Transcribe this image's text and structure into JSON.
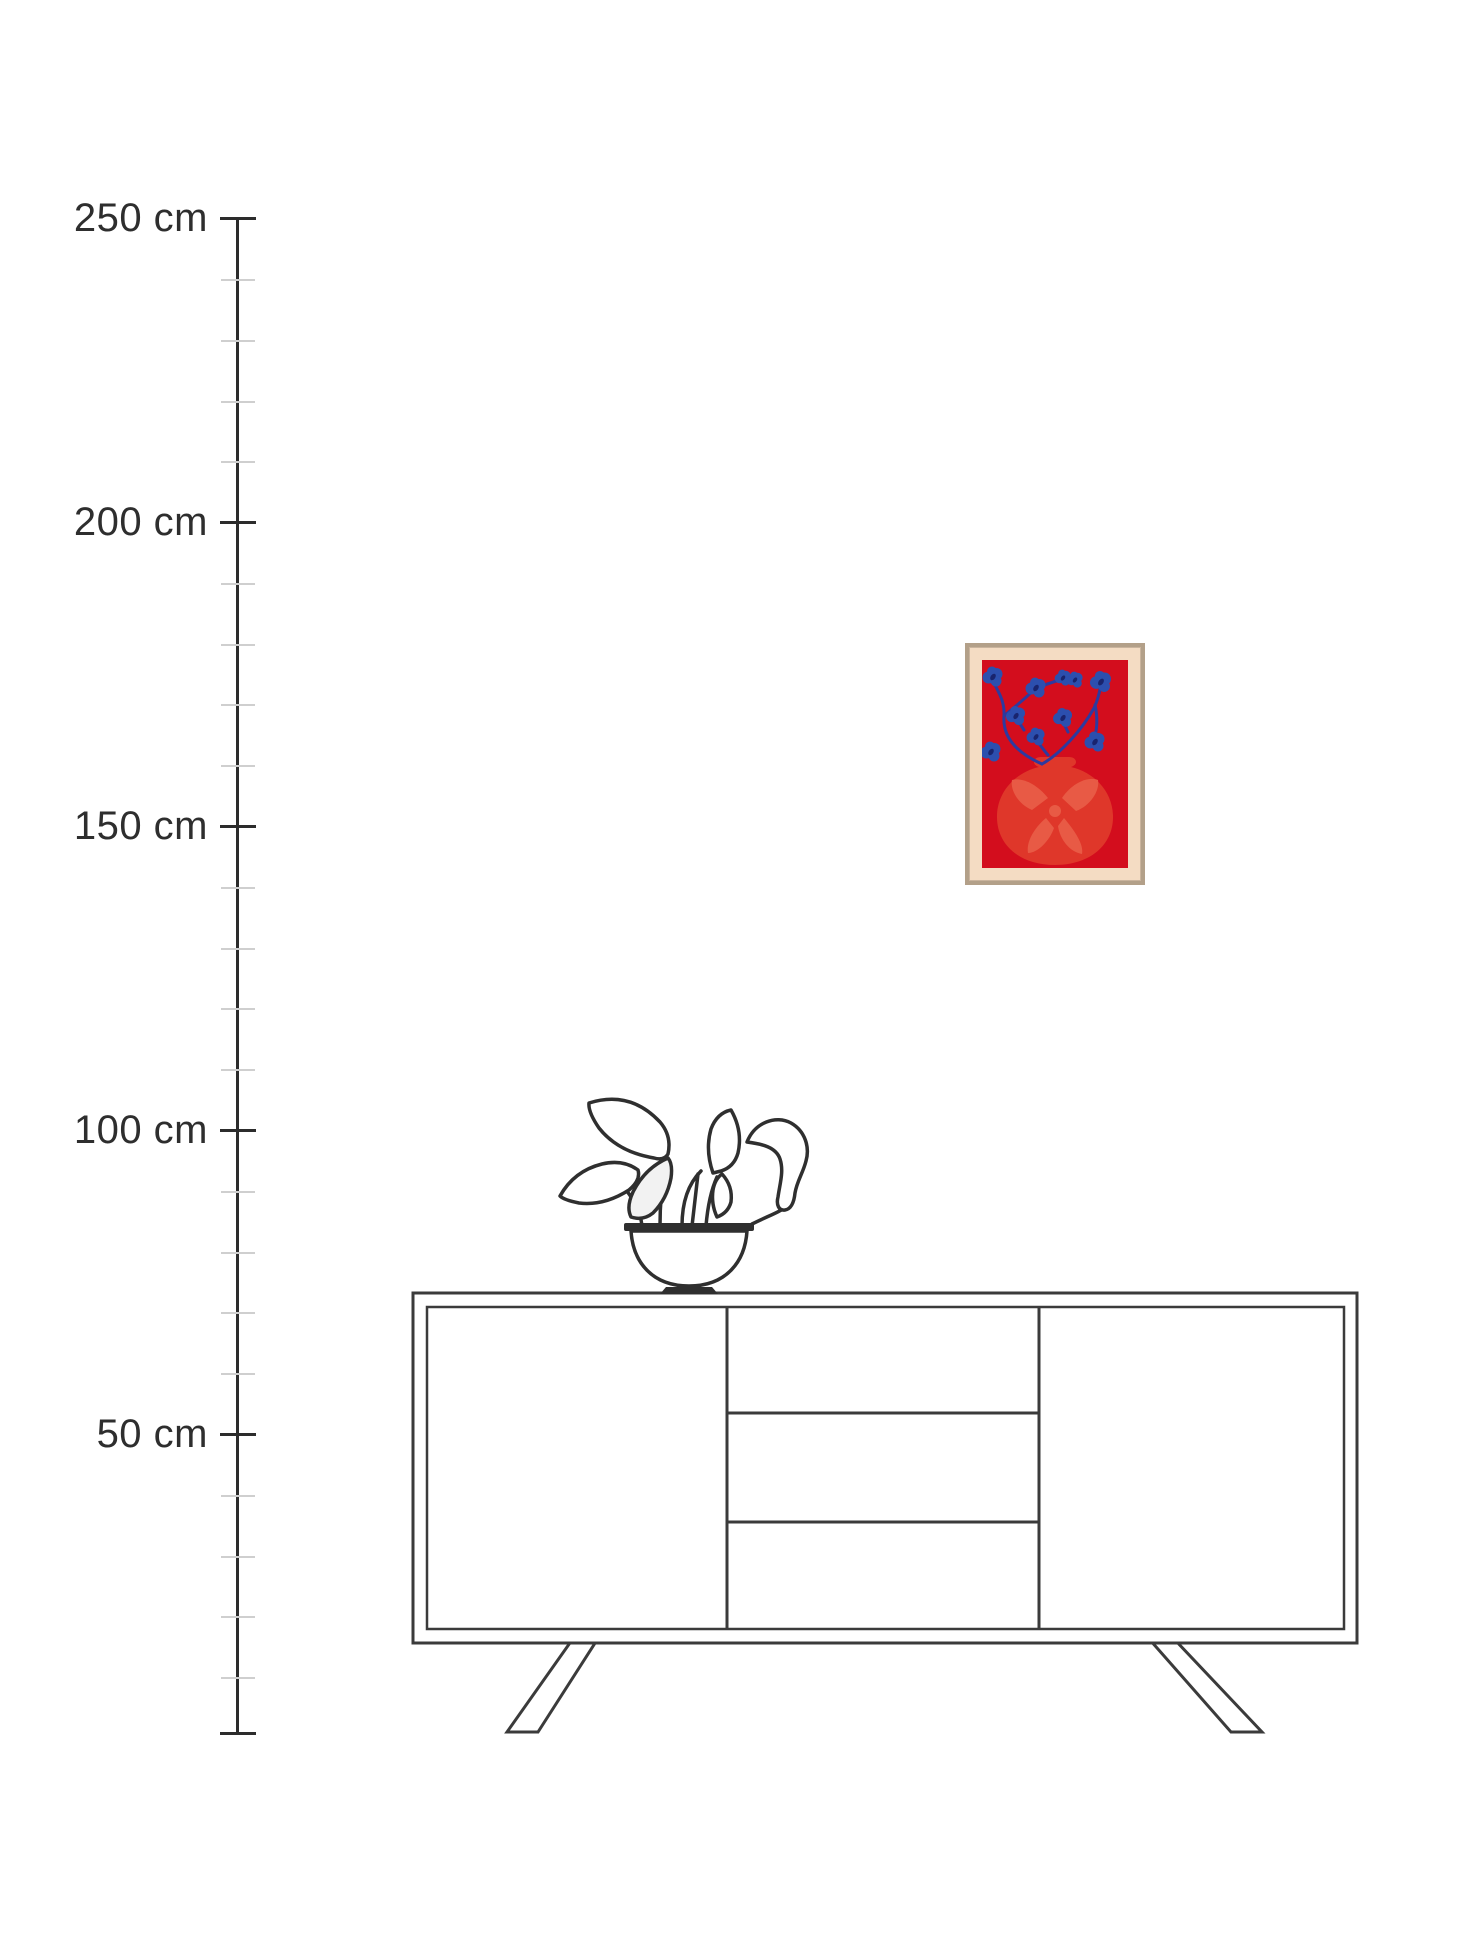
{
  "scene": {
    "type": "product-size-guide",
    "unit": "cm",
    "background_color": "#ffffff"
  },
  "ruler": {
    "labels": [
      {
        "text": "250 cm",
        "value_cm": 250
      },
      {
        "text": "200 cm",
        "value_cm": 200
      },
      {
        "text": "150 cm",
        "value_cm": 150
      },
      {
        "text": "100 cm",
        "value_cm": 100
      },
      {
        "text": "50 cm",
        "value_cm": 50
      }
    ],
    "major_interval_cm": 50,
    "minor_interval_cm": 10,
    "line_color": "#2c2c2c",
    "major_tick_color": "#2c2c2c",
    "minor_tick_color": "#cfcfcf",
    "label_color": "#2e2e2e"
  },
  "poster": {
    "frame_color": "#b3a089",
    "mat_color": "#f4dcc3",
    "artwork": {
      "subject": "blue flowers in a red vase",
      "background_color": "#d30d1d",
      "vase_color": "#df372a",
      "vase_detail_color": "#e85a45",
      "flower_color": "#2c4fae",
      "flower_center_color": "#19246e",
      "stem_color": "#2d3a9f",
      "flower_count": 10
    }
  },
  "furniture": {
    "items": [
      {
        "name": "sideboard",
        "style": "line-drawing",
        "line_color": "#3b3b3b"
      },
      {
        "name": "potted-plant",
        "style": "line-drawing",
        "line_color": "#2f2f2f"
      }
    ]
  }
}
